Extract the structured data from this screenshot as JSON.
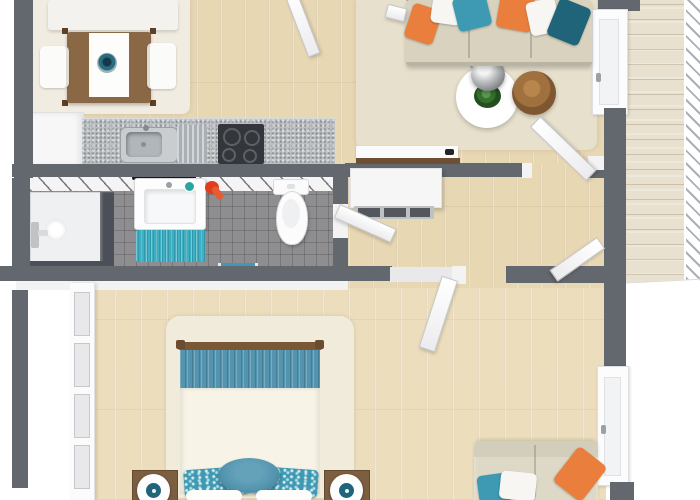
{
  "scene": {
    "title": "Two-room apartment 3D floor plan",
    "view": "top-down 3D render",
    "rooms_count": 7
  },
  "colors": {
    "outside": "#ffffff",
    "wall": "#63676e",
    "wallFace": "#f3f3f4",
    "floorWood": "#e8d7b3",
    "floorWoodBed": "#ecdebd",
    "balconyWood": "#e9e1cf",
    "tile": "#8e8e90",
    "counter": "#bcc0c3",
    "cooktop": "#33363b",
    "glass": "#4b4f57",
    "accentTeal": "#3e9ab2",
    "accentTealDark": "#1f6479",
    "accentOrange": "#e97e3d",
    "bedThrow": "#5494ae",
    "bathMat": "#3db0c4",
    "rugCream": "#f1ece1",
    "rugLiving": "#e7e0cc",
    "rugBedroom": "#f0ebdb",
    "woodTable": "#8b6845",
    "woodSide": "#a0713f",
    "woodNight": "#7c5e40",
    "woodRail": "#7a5836"
  },
  "rooms": {
    "dining": {
      "name": "Dining area",
      "items": [
        "white bench",
        "wooden dining table",
        "white table runner",
        "teal centerpiece bowl",
        "2 white chairs",
        "cream rug"
      ]
    },
    "kitchen": {
      "name": "Kitchen",
      "items": [
        "tall white cabinet",
        "speckled countertop",
        "stainless sink with drainboard",
        "black 4-burner cooktop"
      ]
    },
    "living": {
      "name": "Living room",
      "items": [
        "beige sofa with 6 pillows (orange, white, teal)",
        "chrome arc floor lamp",
        "round white coffee table",
        "potted plant",
        "round wooden side table",
        "beige area rug",
        "media console with wood top",
        "balcony door"
      ]
    },
    "bathroom": {
      "name": "Bathroom",
      "items": [
        "walk-in shower with glass screen",
        "shower fixture",
        "white vanity sink",
        "black wall shelf",
        "teal bath mat",
        "red hair dryer",
        "toilet",
        "teal bath shelf"
      ]
    },
    "hallway": {
      "name": "Hallway",
      "items": [
        "white sideboard with open shelves",
        "4 interior doors"
      ]
    },
    "bedroom": {
      "name": "Bedroom",
      "items": [
        "double bed with teal runner",
        "2 patterned teal pillows",
        "round teal accent pillow",
        "2 wooden nightstands",
        "2 round table lamps",
        "white panel wardrobe",
        "beige loveseat with teal/white/orange pillows",
        "cream shag rug",
        "tall window"
      ]
    },
    "balcony": {
      "name": "Balcony",
      "items": [
        "whitewashed wood decking",
        "white railing"
      ]
    }
  }
}
